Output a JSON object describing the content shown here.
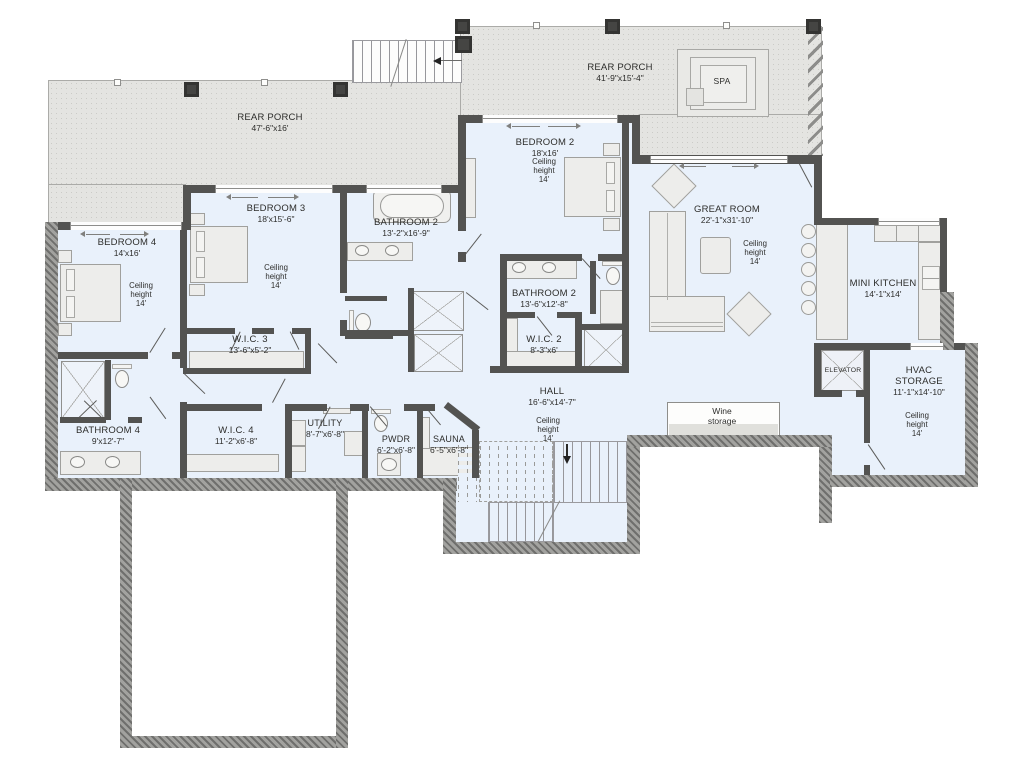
{
  "colors": {
    "room_fill": "#e9f1fb",
    "porch_fill": "#e4e4e1",
    "wall": "#535351",
    "hatched_wall": "#8a8a88",
    "furniture": "#ededeb",
    "text": "#2d2d2b"
  },
  "rooms": {
    "rear_porch_left": {
      "name": "REAR PORCH",
      "dims": "47'-6\"x16'"
    },
    "rear_porch_right": {
      "name": "REAR PORCH",
      "dims": "41'-9\"x15'-4\""
    },
    "spa": {
      "name": "SPA"
    },
    "bedroom_2": {
      "name": "BEDROOM 2",
      "dims": "18'x16'",
      "ceiling": [
        "Ceiling",
        "height",
        "14'"
      ]
    },
    "bedroom_3": {
      "name": "BEDROOM 3",
      "dims": "18'x15'-6\"",
      "ceiling": [
        "Ceiling",
        "height",
        "14'"
      ]
    },
    "bedroom_4": {
      "name": "BEDROOM 4",
      "dims": "14'x16'",
      "ceiling": [
        "Ceiling",
        "height",
        "14'"
      ]
    },
    "bathroom_2_upper": {
      "name": "BATHROOM 2",
      "dims": "13'-2\"x16'-9\""
    },
    "bathroom_2_lower": {
      "name": "BATHROOM 2",
      "dims": "13'-6\"x12'-8\""
    },
    "great_room": {
      "name": "GREAT ROOM",
      "dims": "22'-1\"x31'-10\"",
      "ceiling": [
        "Ceiling",
        "height",
        "14'"
      ]
    },
    "mini_kitchen": {
      "name": "MINI KITCHEN",
      "dims": "14'-1\"x14'"
    },
    "wic_3": {
      "name": "W.I.C. 3",
      "dims": "13'-6\"x5'-2\""
    },
    "wic_2": {
      "name": "W.I.C. 2",
      "dims": "8'-3\"x6'"
    },
    "wic_4": {
      "name": "W.I.C. 4",
      "dims": "11'-2\"x6'-8\""
    },
    "hall": {
      "name": "HALL",
      "dims": "16'-6\"x14'-7\"",
      "ceiling": [
        "Ceiling",
        "height",
        "14'"
      ]
    },
    "elevator": {
      "name": "ELEVATOR"
    },
    "hvac_storage": {
      "name_lines": [
        "HVAC",
        "STORAGE"
      ],
      "dims": "11'-1\"x14'-10\"",
      "ceiling": [
        "Ceiling",
        "height",
        "14'"
      ]
    },
    "wine_storage": {
      "name_lines": [
        "Wine",
        "storage"
      ]
    },
    "bathroom_4": {
      "name": "BATHROOM 4",
      "dims": "9'x12'-7\""
    },
    "utility": {
      "name": "UTILITY",
      "dims": "8'-7\"x6'-8\""
    },
    "pwdr": {
      "name": "PWDR",
      "dims": "6'-2\"x6'-8\""
    },
    "sauna": {
      "name": "SAUNA",
      "dims": "6'-5\"x6'-8\""
    }
  }
}
